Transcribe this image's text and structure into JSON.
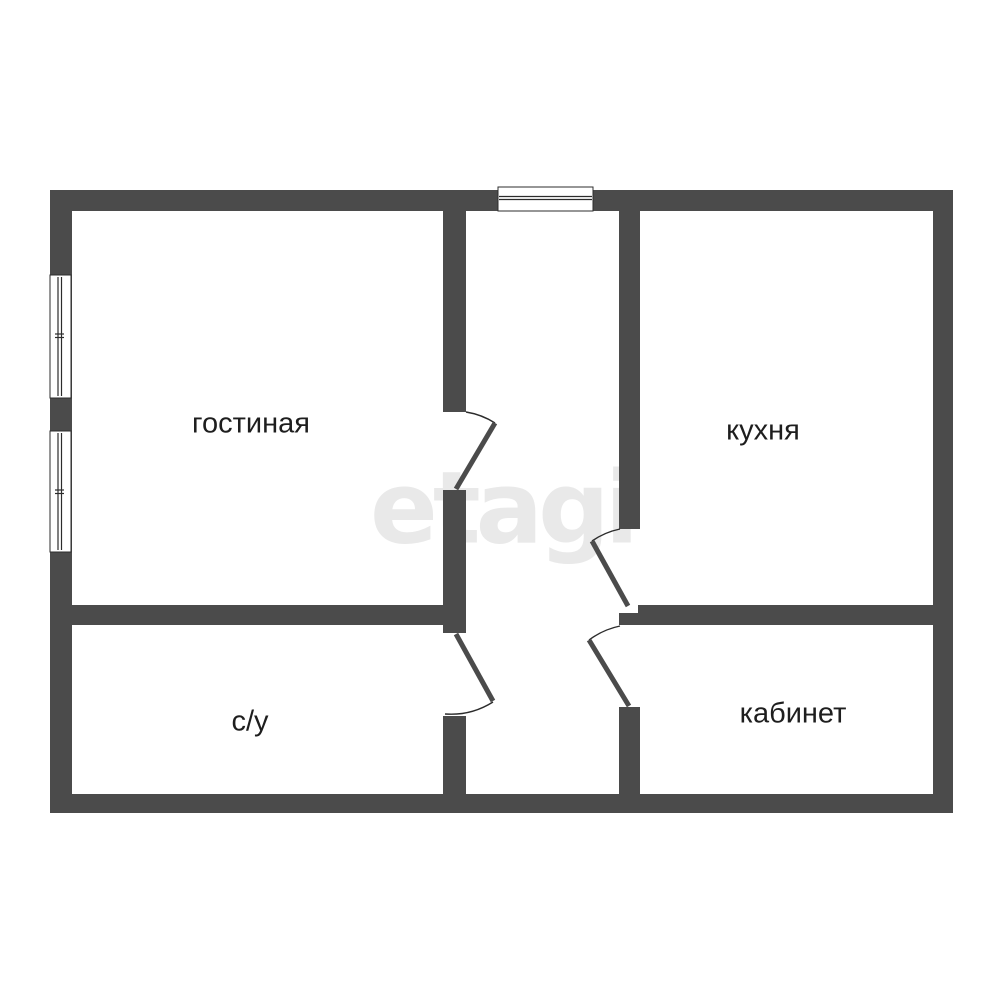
{
  "plan": {
    "rooms": {
      "living": {
        "label": "гостиная"
      },
      "kitchen": {
        "label": "кухня"
      },
      "bathroom": {
        "label": "с/у"
      },
      "office": {
        "label": "кабинет"
      }
    },
    "watermark": {
      "text": "etagi"
    }
  },
  "colors": {
    "wall": "#4b4b4b",
    "line": "#2c2c2c",
    "label": "#1e1e1e",
    "watermark": "#e9e9e9",
    "background": "#ffffff"
  }
}
